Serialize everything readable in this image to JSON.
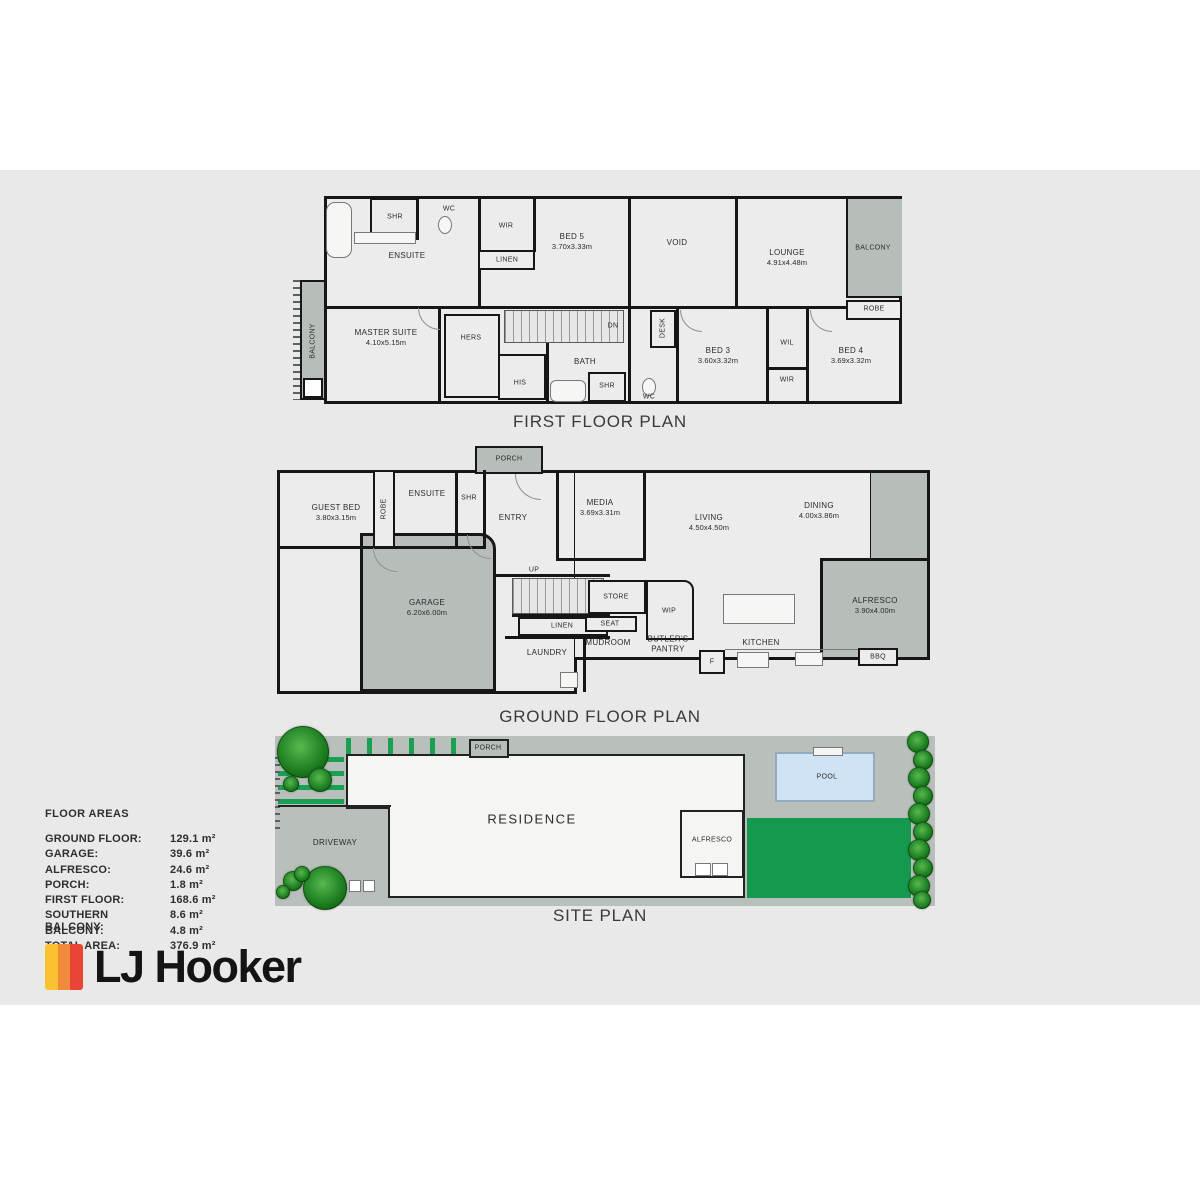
{
  "first_floor": {
    "title": "FIRST FLOOR PLAN",
    "ensuite": "ENSUITE",
    "shr_ensuite": "SHR",
    "wc_top": "WC",
    "wir_top": "WIR",
    "linen": "LINEN",
    "bed5": "BED 5",
    "bed5_dims": "3.70x3.33m",
    "void": "VOID",
    "lounge": "LOUNGE",
    "lounge_dims": "4.91x4.48m",
    "balcony_right": "BALCONY",
    "robe_right": "ROBE",
    "balcony_left": "BALCONY",
    "master": "MASTER SUITE",
    "master_dims": "4.10x5.15m",
    "hers": "HERS",
    "his": "HIS",
    "dn": "DN",
    "desk": "DESK",
    "bath": "BATH",
    "shr_bath": "SHR",
    "wc_bath": "WC",
    "bed3": "BED 3",
    "bed3_dims": "3.60x3.32m",
    "wil": "WIL",
    "wir_bottom": "WIR",
    "bed4": "BED 4",
    "bed4_dims": "3.69x3.32m"
  },
  "ground_floor": {
    "title": "GROUND FLOOR PLAN",
    "porch": "PORCH",
    "guest_bed": "GUEST BED",
    "guest_bed_dims": "3.80x3.15m",
    "robe": "ROBE",
    "ensuite": "ENSUITE",
    "shr": "SHR",
    "entry": "ENTRY",
    "media": "MEDIA",
    "media_dims": "3.69x3.31m",
    "living": "LIVING",
    "living_dims": "4.50x4.50m",
    "dining": "DINING",
    "dining_dims": "4.00x3.86m",
    "garage": "GARAGE",
    "garage_dims": "6.20x6.00m",
    "up": "UP",
    "linen": "LINEN",
    "store": "STORE",
    "wip": "WIP",
    "seat": "SEAT",
    "mudroom": "MUDROOM",
    "butlers_pantry": "BUTLER'S PANTRY",
    "kitchen": "KITCHEN",
    "laundry": "LAUNDRY",
    "fridge": "F",
    "alfresco": "ALFRESCO",
    "alfresco_dims": "3.90x4.00m",
    "bbq": "BBQ"
  },
  "site_plan": {
    "title": "SITE PLAN",
    "porch": "PORCH",
    "residence": "RESIDENCE",
    "driveway": "DRIVEWAY",
    "alfresco": "ALFRESCO",
    "pool": "POOL"
  },
  "floor_areas": {
    "title": "FLOOR AREAS",
    "rows": [
      {
        "label": "GROUND FLOOR:",
        "value": "129.1 m²"
      },
      {
        "label": "GARAGE:",
        "value": "39.6 m²"
      },
      {
        "label": "ALFRESCO:",
        "value": "24.6 m²"
      },
      {
        "label": "PORCH:",
        "value": "1.8 m²"
      },
      {
        "label": "FIRST FLOOR:",
        "value": "168.6 m²"
      },
      {
        "label": "SOUTHERN BALCONY:",
        "value": "8.6 m²"
      },
      {
        "label": "BALCONY:",
        "value": "4.8 m²"
      },
      {
        "label": "TOTAL AREA:",
        "value": "376.9 m²"
      }
    ]
  },
  "brand": {
    "name": "LJ Hooker",
    "colors": {
      "yellow": "#FBC12E",
      "orange": "#F08A3C",
      "red": "#E94435",
      "lawn": "#14994E",
      "pool": "#CFE3F5",
      "plan_gray": "#B7BEBA"
    }
  }
}
